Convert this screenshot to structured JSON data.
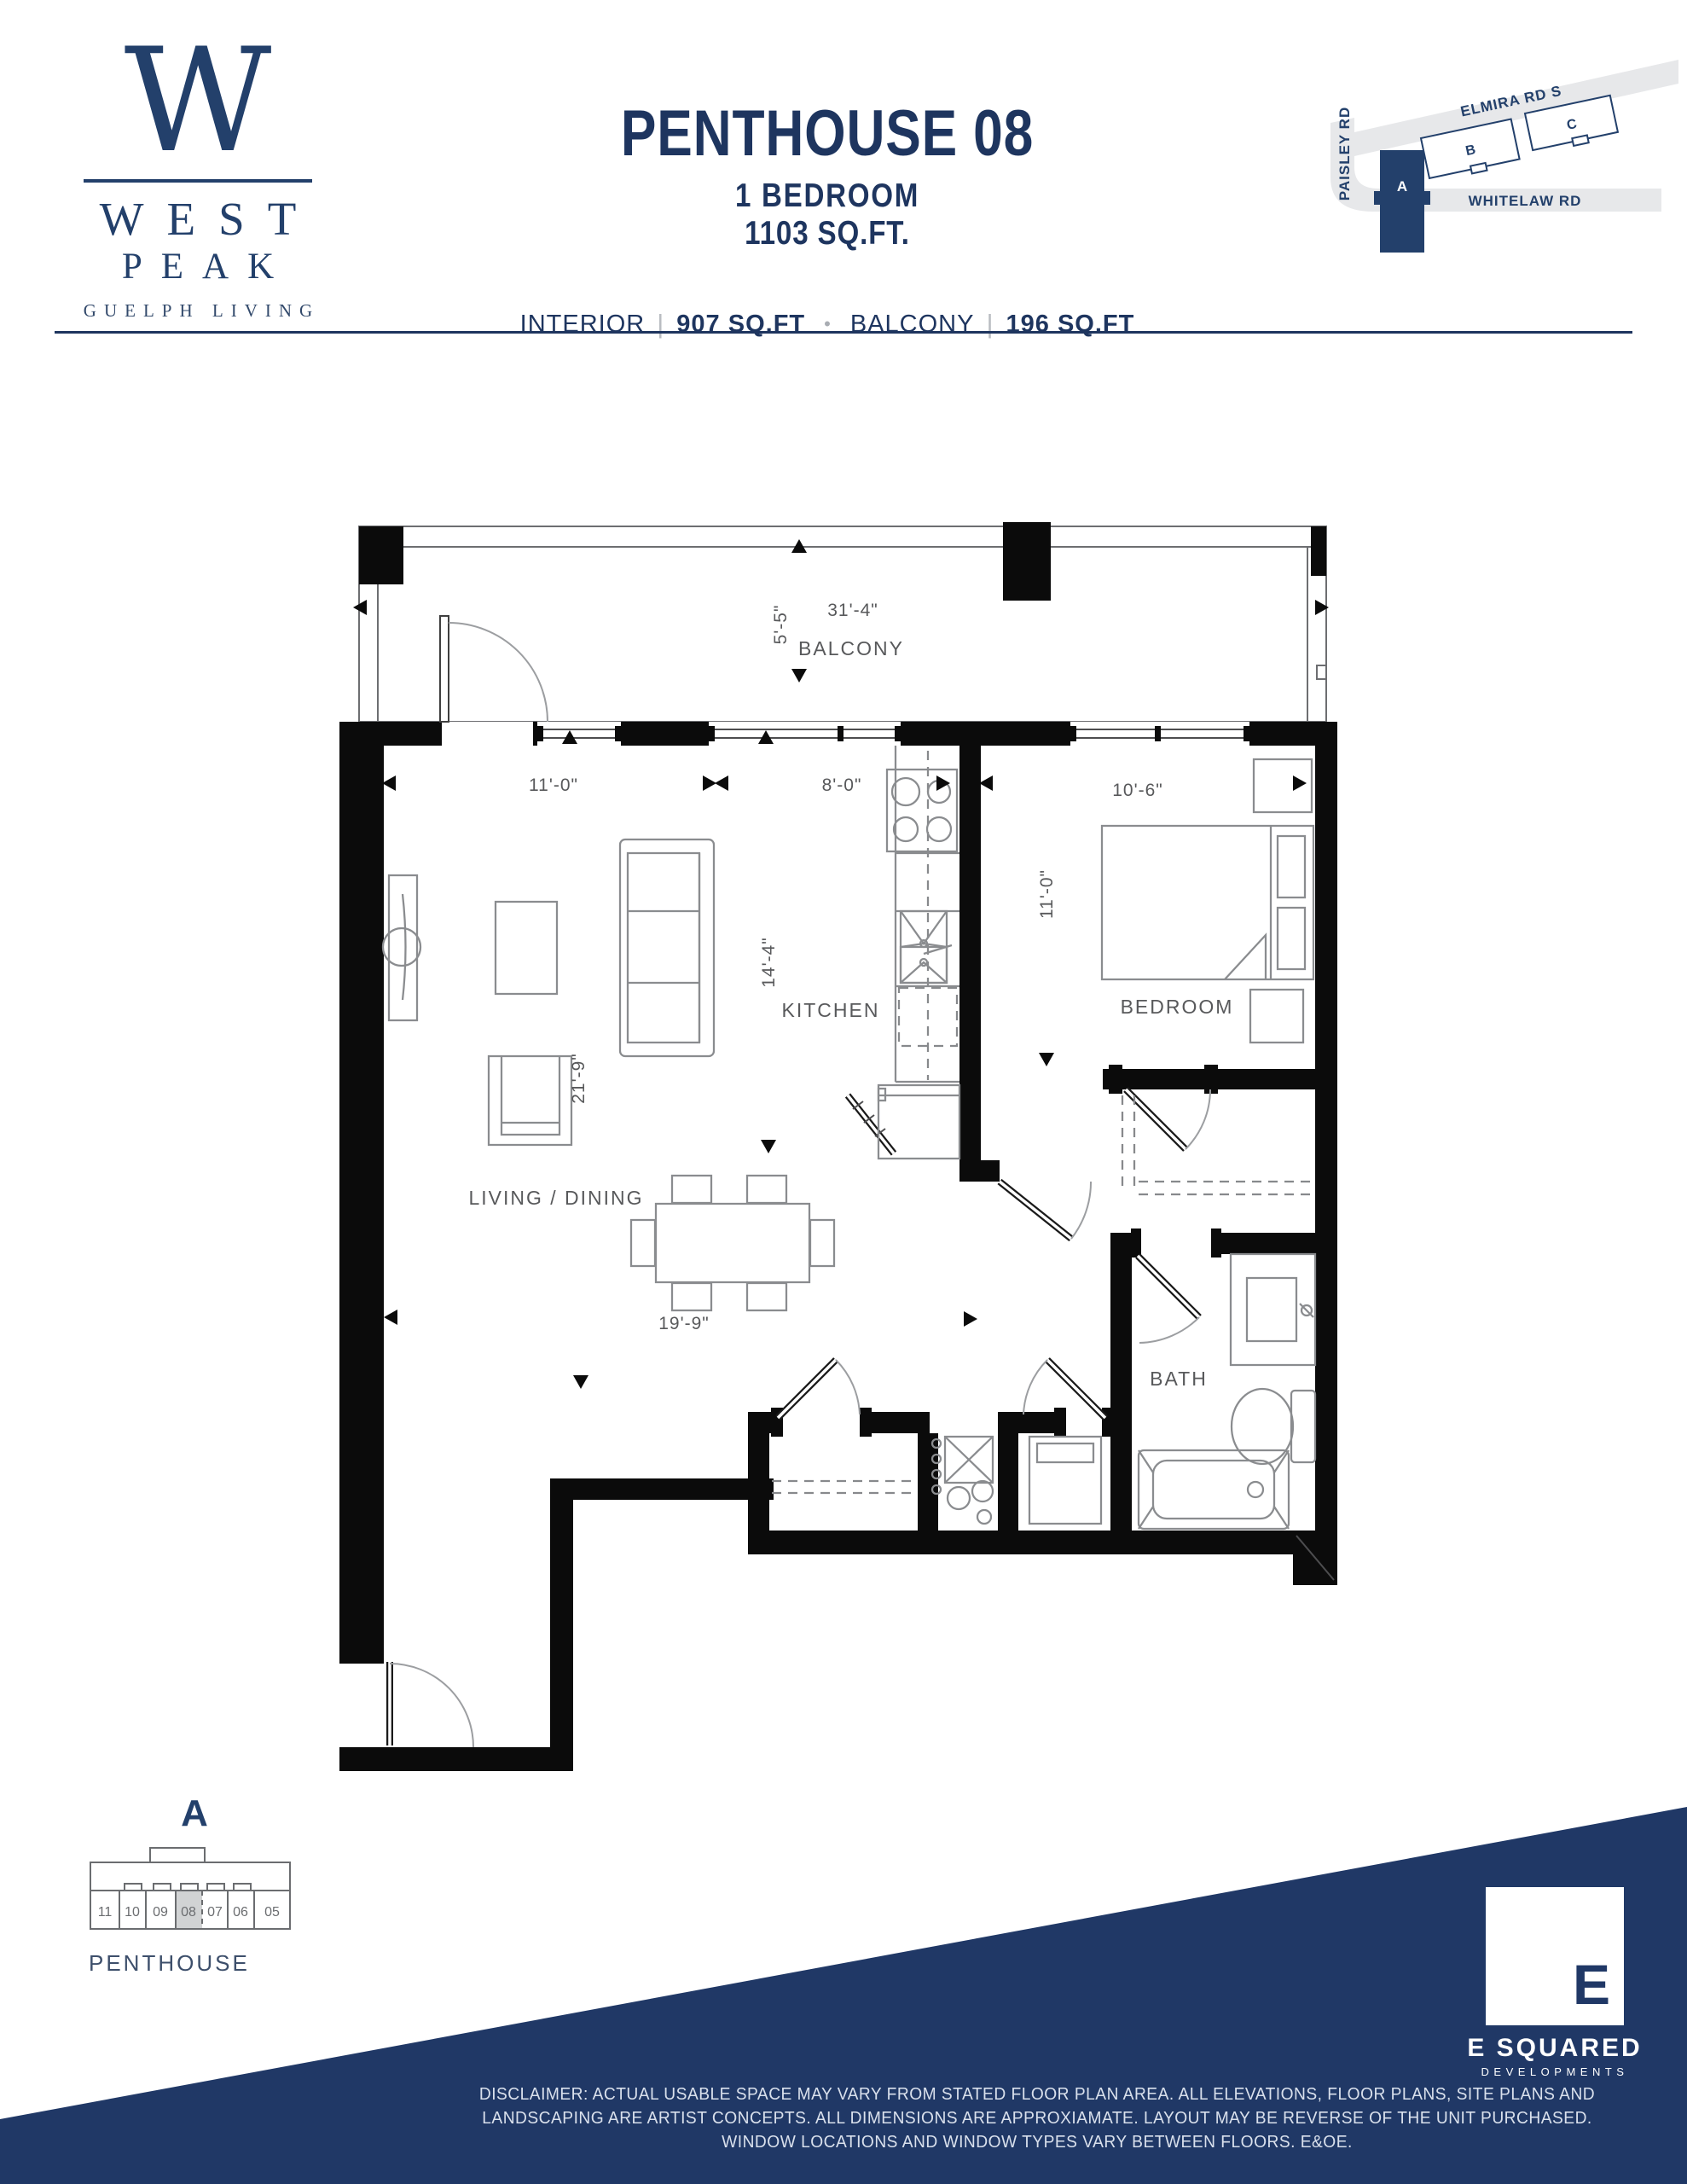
{
  "logo": {
    "monogram": "W",
    "name1": "WEST",
    "name2": "PEAK",
    "tagline": "GUELPH LIVING"
  },
  "unit": {
    "title": "PENTHOUSE 08",
    "bedrooms": "1 BEDROOM",
    "area": "1103 SQ.FT.",
    "interior_label": "INTERIOR",
    "interior_area": "907 SQ.FT",
    "balcony_label": "BALCONY",
    "balcony_area": "196 SQ.FT",
    "divider": "|",
    "bullet": "•"
  },
  "sitemap": {
    "road_top": "ELMIRA RD S",
    "road_left": "PAISLEY RD",
    "road_bottom": "WHITELAW RD",
    "building_a": "A",
    "building_b": "B",
    "building_c": "C"
  },
  "plan": {
    "labels": {
      "balcony": "BALCONY",
      "living": "LIVING / DINING",
      "kitchen": "KITCHEN",
      "bedroom": "BEDROOM",
      "bath": "BATH"
    },
    "dims": {
      "balcony_w": "31'-4\"",
      "balcony_d": "5'-5\"",
      "living_w": "11'-0\"",
      "kitchen_w": "8'-0\"",
      "kitchen_l": "14'-4\"",
      "living_l": "21'-9\"",
      "dining_w": "19'-9\"",
      "bedroom_w": "10'-6\"",
      "bedroom_l": "11'-0\""
    }
  },
  "keyplan": {
    "block": "A",
    "units": [
      "11",
      "10",
      "09",
      "08",
      "07",
      "06",
      "05"
    ],
    "highlighted_unit": "08",
    "label": "PENTHOUSE"
  },
  "developer": {
    "initial": "E",
    "name": "E SQUARED",
    "division": "DEVELOPMENTS"
  },
  "disclaimer": {
    "line1": "DISCLAIMER: ACTUAL USABLE SPACE MAY VARY FROM STATED FLOOR PLAN AREA. ALL ELEVATIONS, FLOOR PLANS, SITE PLANS AND",
    "line2": "LANDSCAPING ARE ARTIST CONCEPTS. ALL DIMENSIONS ARE APPROXIAMATE. LAYOUT MAY BE REVERSE OF THE UNIT PURCHASED.",
    "line3": "WINDOW LOCATIONS AND WINDOW TYPES VARY BETWEEN FLOORS. E&OE."
  },
  "colors": {
    "navy": "#203866",
    "title_navy": "#1e355f",
    "dim_gray": "#58595b",
    "road_gray": "#e7e8ea",
    "unit_highlight": "#d1d3d4",
    "wall_black": "#0b0b0b"
  }
}
